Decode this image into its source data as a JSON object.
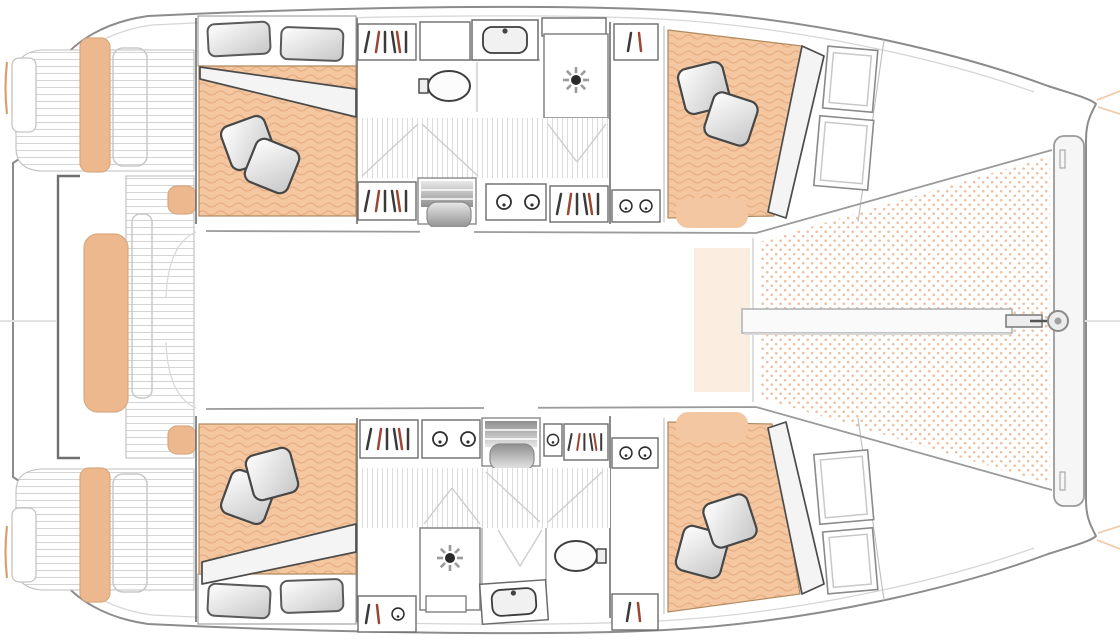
{
  "meta": {
    "app": "yacht-floorplan",
    "description": "Top-view accommodation / deck plan of a 4-cabin sailing catamaran, bow to the right, no visible text in the drawing",
    "visible_text": []
  },
  "colors": {
    "background": "#ffffff",
    "hull_outline": "#8c8c8c",
    "hull_inner_line": "#d6d6d6",
    "wall": "#6d6d6d",
    "light_line": "#cdcdcd",
    "plank_line": "#d4d4d4",
    "floor_stripe": "#dcdcdc",
    "mattress_fill": "#f4c7a0",
    "mattress_wave": "#e7ae83",
    "mattress_edge": "#b08a5e",
    "cushion_fill": "#edb88e",
    "cushion_edge": "#d9a87f",
    "deck_pad": "#f3c7a2",
    "tramp_dot": "#ecc2a6",
    "blanket_fill": "#f4f4f4",
    "blanket_edge": "#4c4c4c",
    "pillow_edge": "#474747",
    "steps_dark": "#8f8f8f",
    "steps_light": "#e8e8e8",
    "glyph_dark": "#3a3a3a",
    "glyph_red": "#9c4631",
    "beam_fill": "#f6f6f6",
    "beam_edge": "#9a9a9a",
    "accent_tint": "#fbeee1",
    "bow_ray": "#f1c7a4",
    "tan_mark": "#d9a06e",
    "centerline": "#e3e3e3"
  },
  "layout": {
    "orientation": "bow-right",
    "hulls": 2,
    "cabins": 4,
    "heads": 2,
    "berths_per_cabin": 1
  },
  "features": {
    "port_hull": [
      "aft-double-berth",
      "hanging-lockers",
      "head-with-washbasin-toilet-shower",
      "companionway-steps",
      "forward-double-berth",
      "bow-storage-shelves"
    ],
    "starboard_hull": [
      "aft-double-berth",
      "hanging-lockers",
      "head-with-washbasin-toilet-shower",
      "companionway-steps",
      "forward-double-berth",
      "bow-storage-shelves"
    ],
    "deck": [
      "transom-platforms",
      "aft-cockpit-bench",
      "side-seats",
      "cockpit-table-outline",
      "foredeck-pads",
      "trampoline-net",
      "longitudinal-beam",
      "forward-crossbeam",
      "bowsprit-fitting"
    ]
  },
  "symbols": [
    "pillow",
    "head-pillow",
    "blanket-fold",
    "shower-rose",
    "toilet",
    "washbasin",
    "hanging-locker-glyph",
    "porthole-knob",
    "companionway-steps",
    "deck-planks",
    "net-dots"
  ]
}
